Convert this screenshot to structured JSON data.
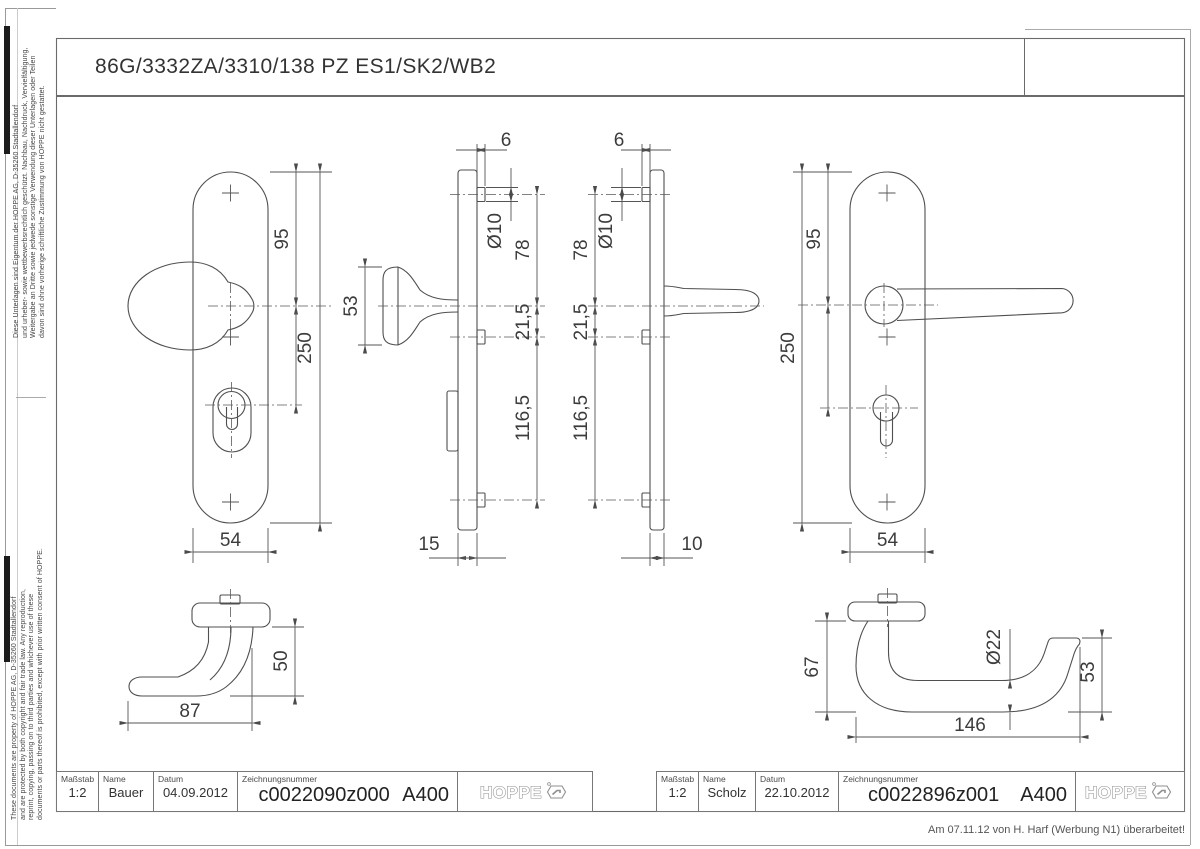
{
  "sheet": {
    "title": "86G/3332ZA/3310/138 PZ ES1/SK2/WB2",
    "revision_note": "Am 07.11.12 von H. Harf (Werbung N1) überarbeitet!",
    "side_note_de_lines": [
      "Diese Unterlagen sind Eigentum der HOPPE AG, D-35260 Stadtallendorf",
      "und urheber- sowie wettbewerbsrechtlich geschützt. Nachbau, Nachdruck, Vervielfältigung,",
      "Weitergabe an Dritte sowie jedwede sonstige Verwendung dieser Unterlagen oder Teilen",
      "davon sind ohne vorherige schriftliche Zustimmung von HOPPE nicht gestattet."
    ],
    "side_note_en_lines": [
      "These documents are property of HOPPE AG, D-35260 Stadtallendorf",
      "and are protected by both copyright and fair trade law. Any reproduction,",
      "reprint, copying, passing on to third parties and whichever use of these",
      "documents or parts thereof is prohibited, except with prior written consent of HOPPE."
    ]
  },
  "title_blocks": [
    {
      "scale_label": "Maßstab",
      "scale": "1:2",
      "name_label": "Name",
      "name": "Bauer",
      "date_label": "Datum",
      "date": "04.09.2012",
      "drawing_no_label": "Zeichnungsnummer",
      "drawing_no": "c0022090z000",
      "sheet_code": "A400",
      "logo": "HOPPE"
    },
    {
      "scale_label": "Maßstab",
      "scale": "1:2",
      "name_label": "Name",
      "name": "Scholz",
      "date_label": "Datum",
      "date": "22.10.2012",
      "drawing_no_label": "Zeichnungsnummer",
      "drawing_no": "c0022896z001",
      "sheet_code": "A400",
      "logo": "HOPPE"
    }
  ],
  "dimensions": {
    "knob_front": {
      "d95": "95",
      "d250": "250",
      "d54": "54"
    },
    "knob_side": {
      "d6": "6",
      "dia10": "Ø10",
      "d78": "78",
      "d21_5": "21,5",
      "d116_5": "116,5",
      "d53": "53",
      "d15": "15"
    },
    "lever_side": {
      "d6": "6",
      "dia10": "Ø10",
      "d78": "78",
      "d21_5": "21,5",
      "d116_5": "116,5",
      "d10": "10"
    },
    "lever_front": {
      "d95": "95",
      "d250": "250",
      "d54": "54"
    },
    "knob_profile": {
      "d50": "50",
      "d87": "87"
    },
    "lever_profile": {
      "d67": "67",
      "dia22": "Ø22",
      "d53": "53",
      "d146": "146"
    }
  }
}
